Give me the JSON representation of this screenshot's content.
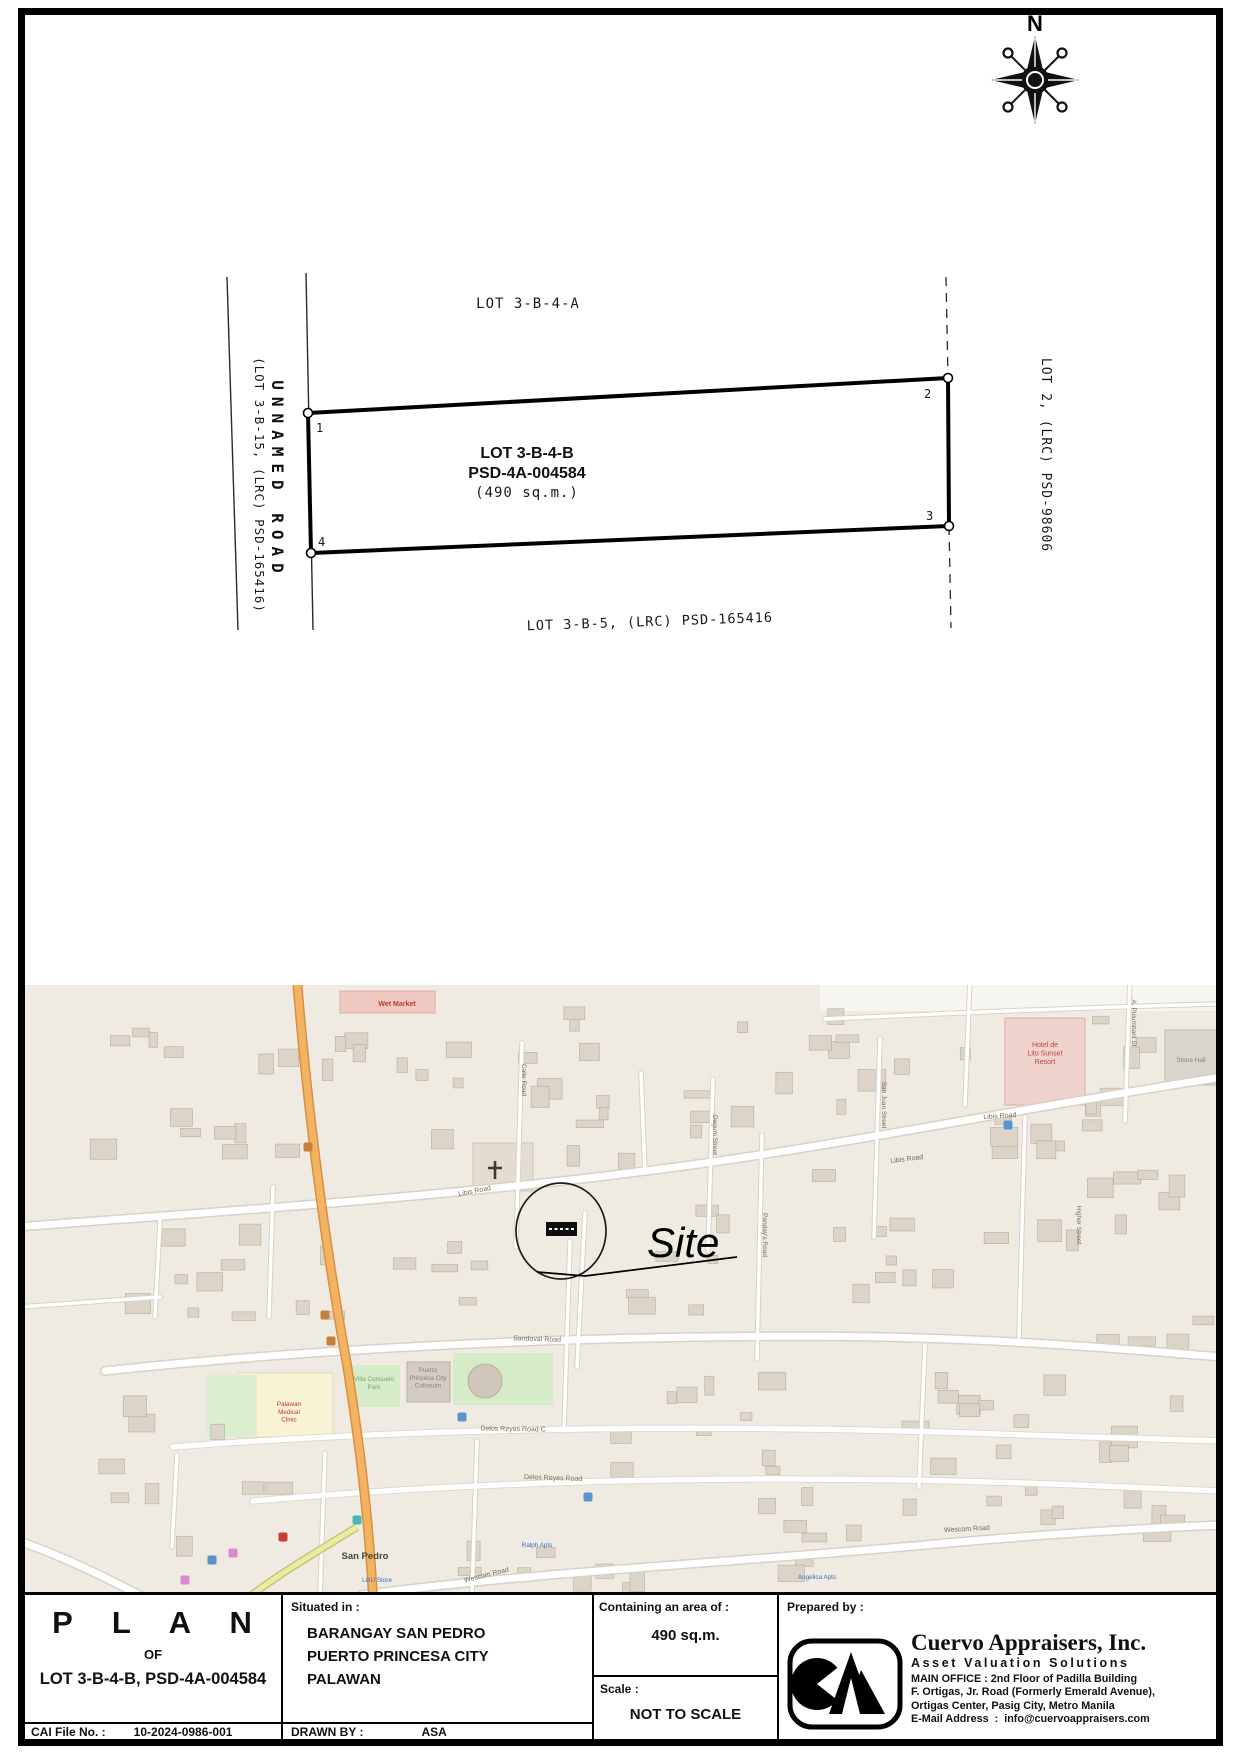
{
  "compass": {
    "n": "N"
  },
  "plan": {
    "north_lot": "LOT 3-B-4-A",
    "lot_name": "LOT 3-B-4-B",
    "lot_psd": "PSD-4A-004584",
    "lot_area": "(490 sq.m.)",
    "south_lot": "LOT 3-B-5, (LRC) PSD-165416",
    "west_road": "UNNAMED ROAD",
    "west_road_sub": "(LOT 3-B-15, (LRC) PSD-165416)",
    "east_lot": "LOT 2, (LRC) PSD-98606",
    "corners": [
      "1",
      "2",
      "3",
      "4"
    ]
  },
  "map": {
    "site": "Site",
    "road_labels": [
      {
        "t": "Libis Road",
        "x": 450,
        "y": 208,
        "r": -11
      },
      {
        "t": "Libis Road",
        "x": 882,
        "y": 176,
        "r": -7
      },
      {
        "t": "Libis Road",
        "x": 975,
        "y": 133,
        "r": -4
      },
      {
        "t": "Sandoval Road",
        "x": 512,
        "y": 356,
        "r": 2
      },
      {
        "t": "Delos Reyes Road C",
        "x": 488,
        "y": 446,
        "r": 1
      },
      {
        "t": "Delos Reyes Road",
        "x": 528,
        "y": 495,
        "r": 2
      },
      {
        "t": "Wescom Road",
        "x": 462,
        "y": 592,
        "r": -14
      },
      {
        "t": "Wescom Road",
        "x": 942,
        "y": 546,
        "r": -3
      }
    ],
    "street_labels_vertical": [
      {
        "t": "Calle Road",
        "x": 497,
        "y": 95
      },
      {
        "t": "Dagum Street",
        "x": 688,
        "y": 150
      },
      {
        "t": "Panday's Road",
        "x": 738,
        "y": 250
      },
      {
        "t": "San Juan Street",
        "x": 857,
        "y": 120
      },
      {
        "t": "A. Pulumbarit St",
        "x": 1107,
        "y": 38
      },
      {
        "t": "Higher Street",
        "x": 1052,
        "y": 240
      }
    ],
    "poi_labels": [
      {
        "lines": [
          "Wet Market"
        ],
        "x": 372,
        "y": 21,
        "c": "#c0392b",
        "s": 7,
        "b": true
      },
      {
        "lines": [
          "Hotel de",
          "Lito Sunset",
          "Resort"
        ],
        "x": 1020,
        "y": 62,
        "c": "#b8443c",
        "s": 7
      },
      {
        "lines": [
          "Villa Consuelo",
          "Park"
        ],
        "x": 349,
        "y": 396,
        "c": "#79a86d",
        "s": 6.3
      },
      {
        "lines": [
          "Puerto",
          "Princesa City",
          "Coliseum"
        ],
        "x": 403,
        "y": 387,
        "c": "#8a8377",
        "s": 6.3
      },
      {
        "lines": [
          "Palawan",
          "Medical",
          "Clinic"
        ],
        "x": 264,
        "y": 421,
        "c": "#c0392b",
        "s": 6.3
      },
      {
        "lines": [
          "San Pedro"
        ],
        "x": 340,
        "y": 574,
        "c": "#474335",
        "s": 9.5,
        "b": true
      },
      {
        "lines": [
          "LGU Store"
        ],
        "x": 352,
        "y": 597,
        "c": "#3b6fb5",
        "s": 6.3
      },
      {
        "lines": [
          "Ralph Apts"
        ],
        "x": 512,
        "y": 562,
        "c": "#3b6fb5",
        "s": 6.3
      },
      {
        "lines": [
          "Angelica Apts"
        ],
        "x": 792,
        "y": 594,
        "c": "#3b6fb5",
        "s": 6.3
      },
      {
        "lines": [
          "Stone Hall"
        ],
        "x": 1166,
        "y": 77,
        "c": "#8a8377",
        "s": 6.3
      }
    ],
    "icons": [
      {
        "x": 437,
        "y": 432,
        "c": "#5b93cf",
        "n": "poi-blue"
      },
      {
        "x": 563,
        "y": 512,
        "c": "#5b93cf",
        "n": "poi-blue"
      },
      {
        "x": 187,
        "y": 575,
        "c": "#5b93cf",
        "n": "poi-blue"
      },
      {
        "x": 983,
        "y": 140,
        "c": "#5b93cf",
        "n": "poi-blue"
      },
      {
        "x": 332,
        "y": 535,
        "c": "#49b8b0",
        "n": "poi-teal"
      },
      {
        "x": 258,
        "y": 552,
        "c": "#cc3b33",
        "n": "poi-red"
      },
      {
        "x": 300,
        "y": 330,
        "c": "#c77f3e",
        "n": "poi-orange"
      },
      {
        "x": 306,
        "y": 356,
        "c": "#c77f3e",
        "n": "poi-orange"
      },
      {
        "x": 283,
        "y": 162,
        "c": "#c77f3e",
        "n": "poi-orange"
      },
      {
        "x": 160,
        "y": 595,
        "c": "#d98ad1",
        "n": "poi-pink"
      },
      {
        "x": 208,
        "y": 568,
        "c": "#d98ad1",
        "n": "poi-pink"
      }
    ],
    "building_clusters": [
      [
        40,
        40,
        180,
        120,
        10
      ],
      [
        230,
        30,
        200,
        140,
        12
      ],
      [
        450,
        20,
        220,
        150,
        14
      ],
      [
        700,
        20,
        180,
        120,
        10
      ],
      [
        900,
        30,
        240,
        140,
        12
      ],
      [
        60,
        230,
        180,
        100,
        8
      ],
      [
        250,
        240,
        200,
        90,
        8
      ],
      [
        560,
        210,
        160,
        110,
        10
      ],
      [
        780,
        180,
        180,
        120,
        10
      ],
      [
        990,
        150,
        180,
        120,
        10
      ],
      [
        60,
        470,
        200,
        90,
        6
      ],
      [
        560,
        380,
        200,
        110,
        10
      ],
      [
        800,
        370,
        220,
        120,
        10
      ],
      [
        1040,
        330,
        140,
        150,
        8
      ],
      [
        420,
        520,
        200,
        80,
        8
      ],
      [
        660,
        500,
        220,
        90,
        8
      ],
      [
        950,
        470,
        200,
        100,
        8
      ],
      [
        80,
        390,
        110,
        70,
        4
      ]
    ]
  },
  "tb": {
    "plan_word": "P L A N",
    "of": "OF",
    "lot_line": "LOT 3-B-4-B, PSD-4A-004584",
    "cai_label": "CAI File No. :",
    "cai_value": "10-2024-0986-001",
    "situated_label": "Situated in :",
    "situated1": "BARANGAY SAN PEDRO",
    "situated2": "PUERTO PRINCESA CITY",
    "situated3": "PALAWAN",
    "drawn_label": "DRAWN BY :",
    "drawn_value": "ASA",
    "area_label": "Containing an area of :",
    "area_value": "490 sq.m.",
    "scale_label": "Scale :",
    "scale_value": "NOT TO SCALE",
    "prepared_label": "Prepared by :",
    "company": "Cuervo Appraisers, Inc.",
    "tagline": "Asset Valuation Solutions",
    "address1": "MAIN OFFICE : 2nd Floor of Padilla Building",
    "address2": "F. Ortigas, Jr. Road (Formerly Emerald Avenue),",
    "address3": "Ortigas Center, Pasig City, Metro Manila",
    "email": "E-Mail Address  :  info@cuervoappraisers.com"
  }
}
